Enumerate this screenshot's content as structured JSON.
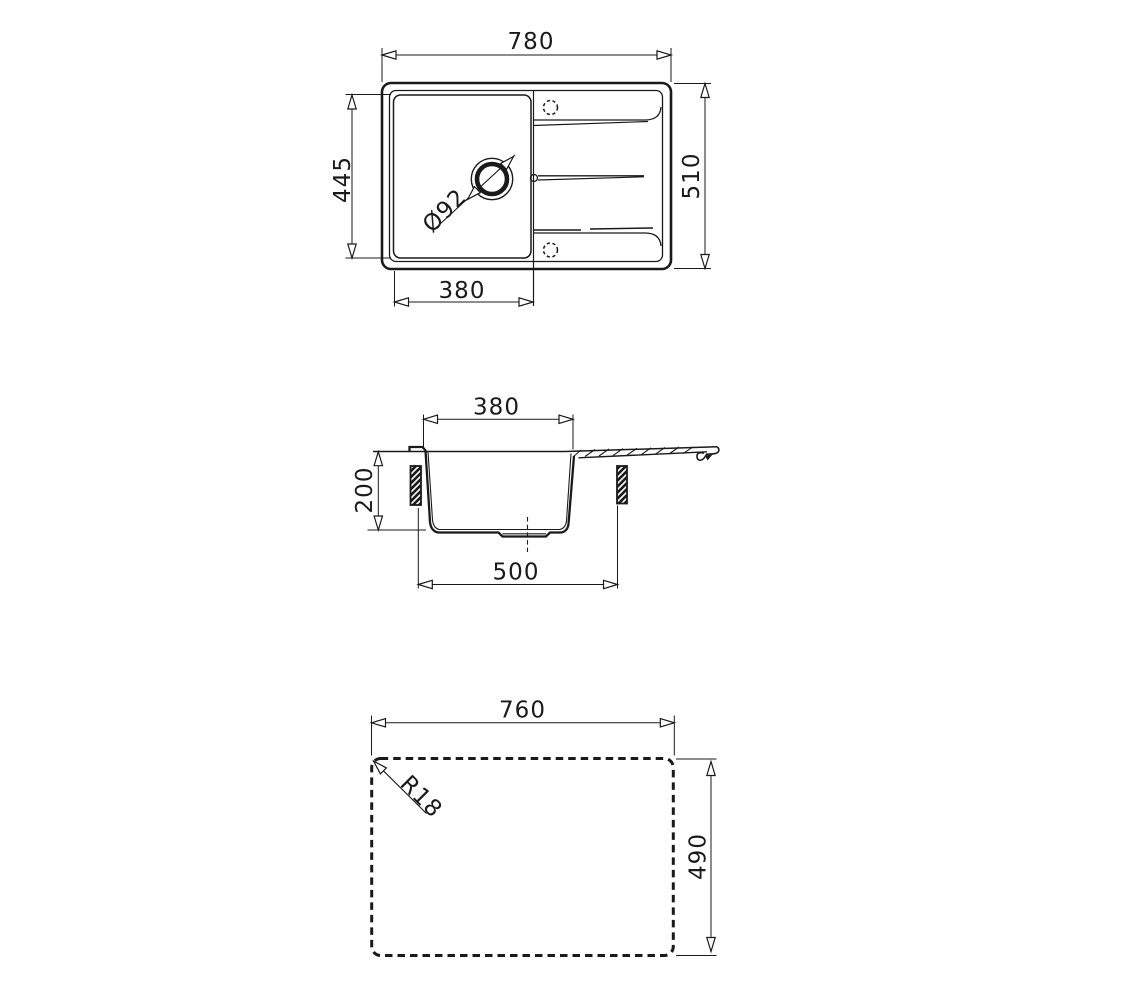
{
  "page": {
    "background": "#ffffff",
    "line_color": "#1a1a1a",
    "description": "Sink technical drawing, three views"
  },
  "views": {
    "top": {
      "overall_width": "780",
      "overall_depth": "510",
      "bowl_length": "445",
      "bowl_width": "380",
      "drain_diameter": "Ø92"
    },
    "section": {
      "rim_width": "380",
      "bowl_depth": "200",
      "base_width": "500"
    },
    "cutout": {
      "width": "760",
      "depth": "490",
      "corner_radius": "R18"
    }
  }
}
